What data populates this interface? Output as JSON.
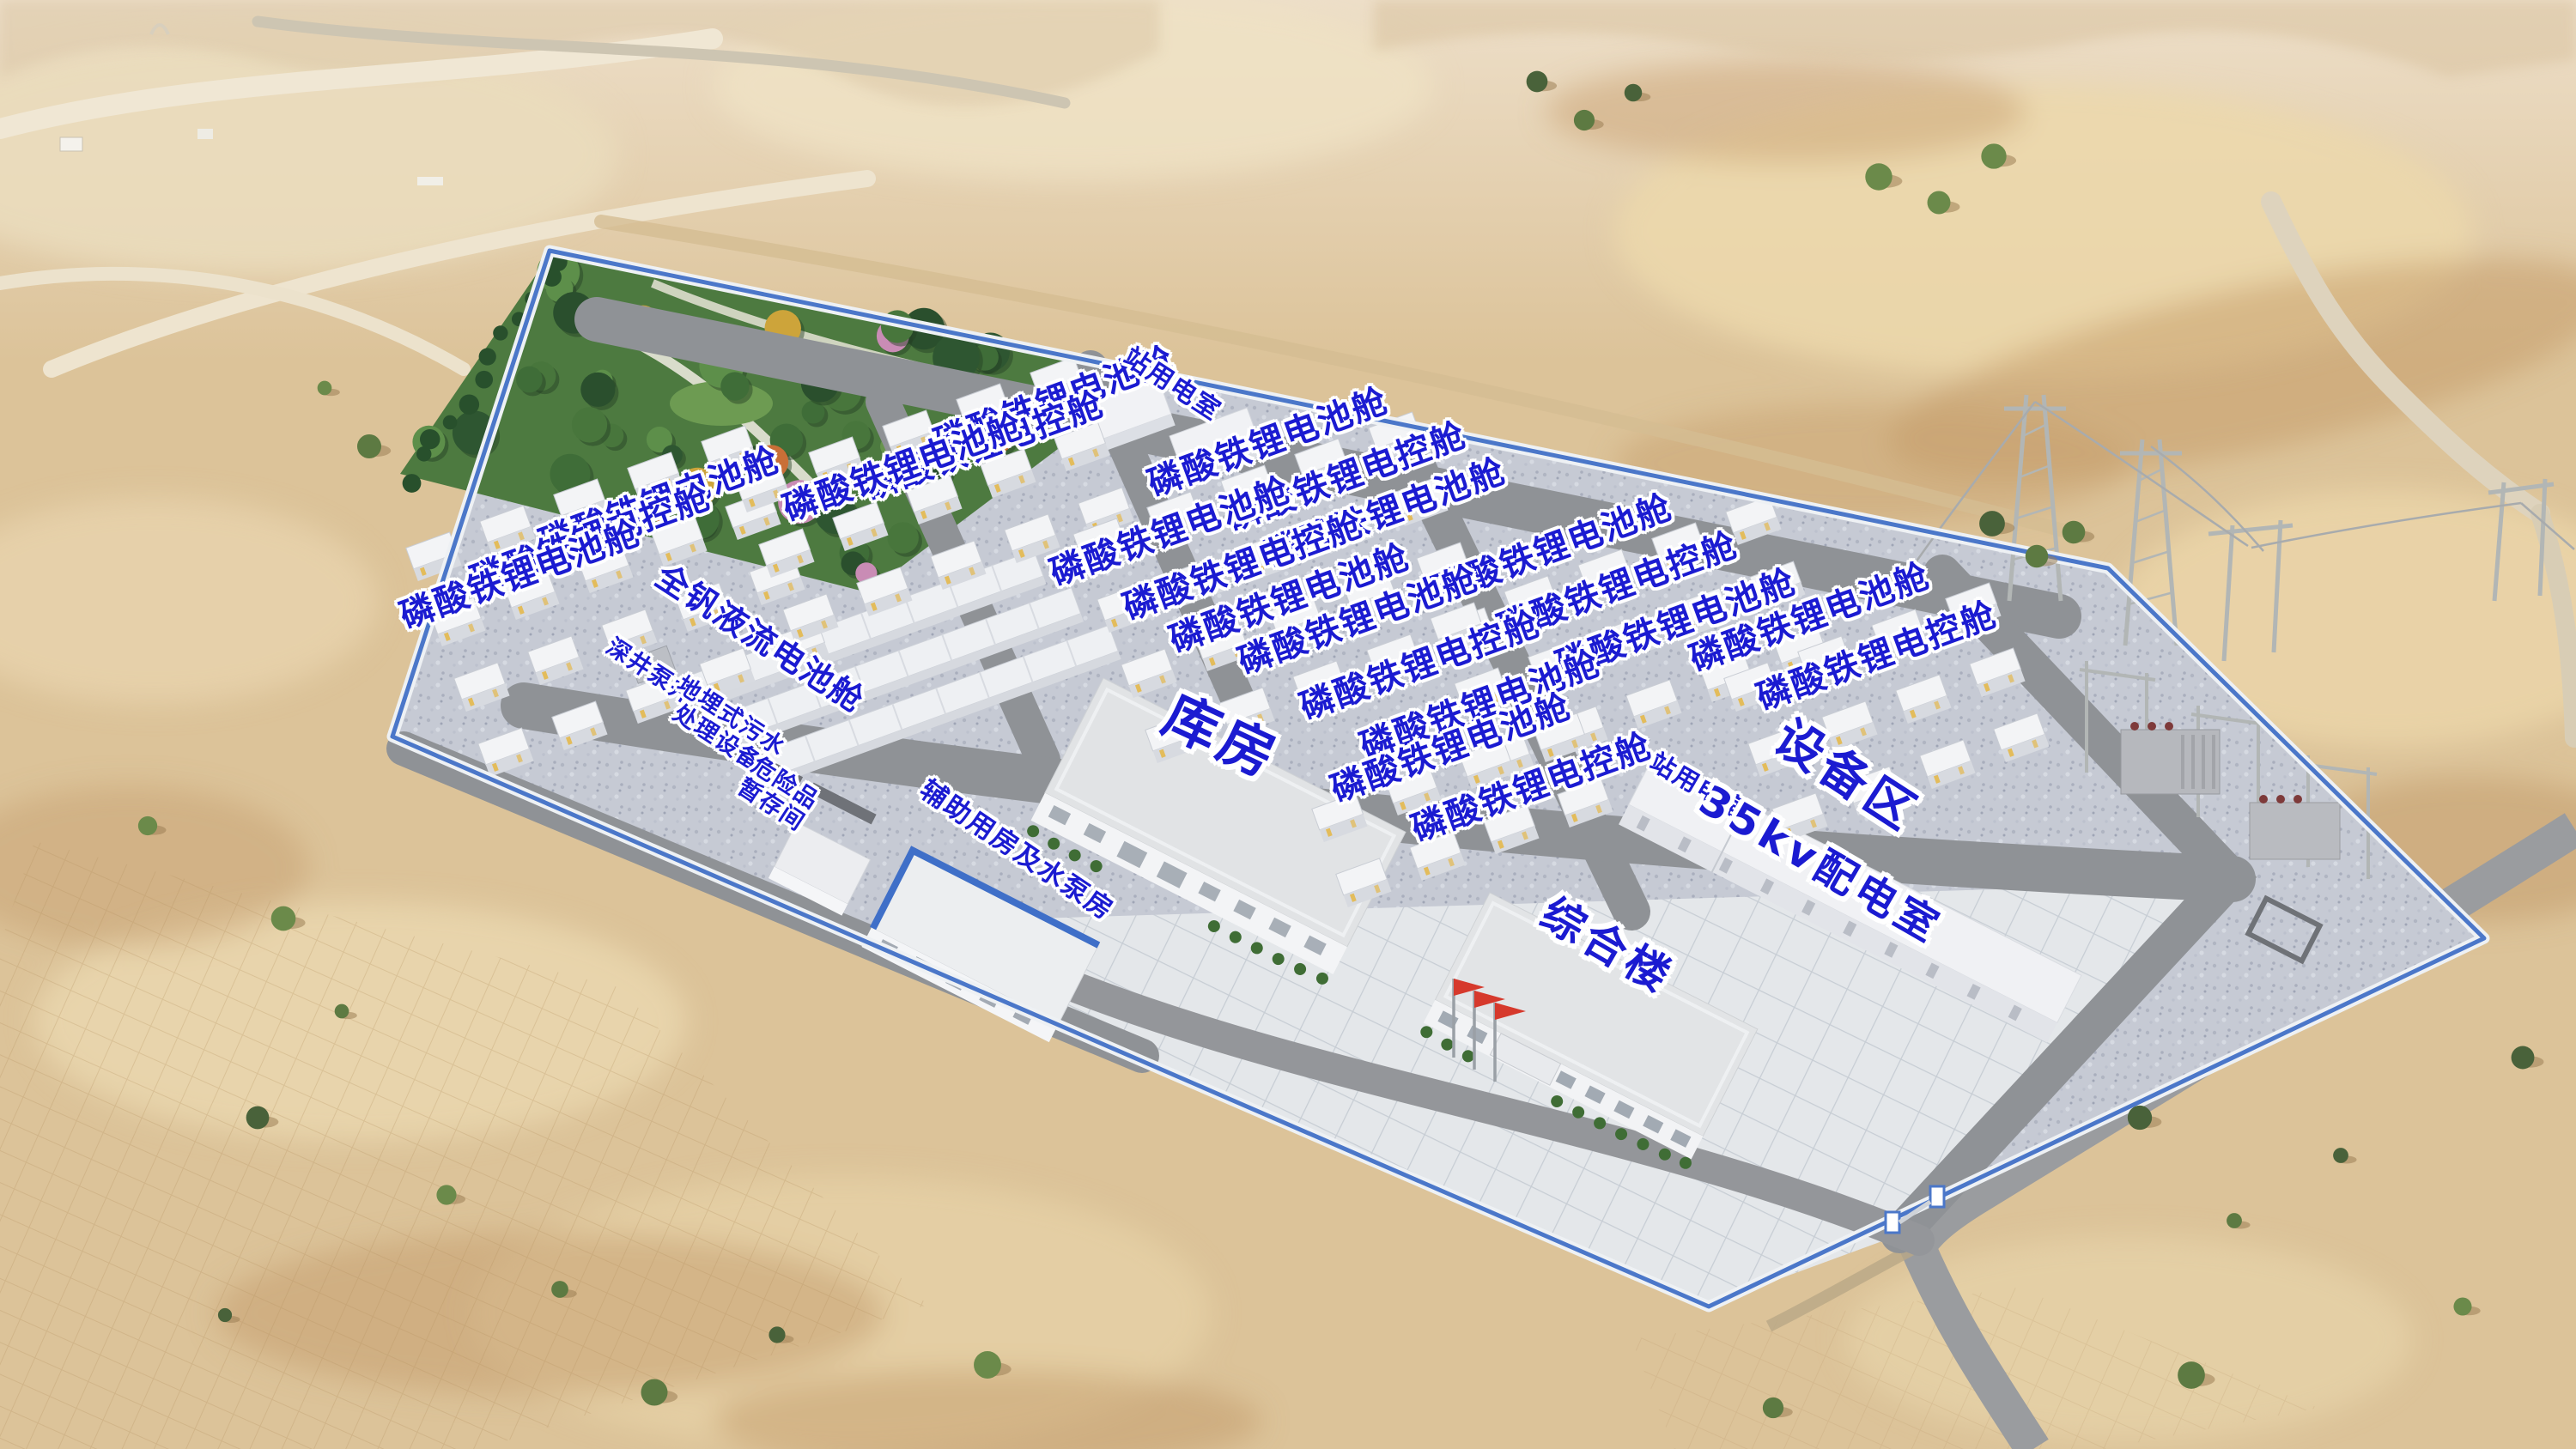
{
  "labels": {
    "battery_cabin": "磷酸铁锂电池舱",
    "control_cabin": "磷酸铁锂电控舱",
    "vanadium_flow_cabin": "全钒液流电池舱",
    "station_power_room": "站用电室",
    "deep_well_pump": "深井泵井",
    "sewage_treatment_line1": "地埋式污水",
    "sewage_treatment_line2": "处理设备",
    "hazardous_storage_line1": "危险品",
    "hazardous_storage_line2": "暂存间",
    "auxiliary_pump_house": "辅助用房及水泵房",
    "warehouse": "库房",
    "comprehensive_building": "综合楼",
    "distribution_room_35kv": "35kv配电室",
    "equipment_area": "设备区"
  },
  "colors": {
    "label_blue": "#1b1bd1",
    "fence_blue": "#4b77c9",
    "road_gray": "#8f9296",
    "sand": "#dcc399",
    "gravel_pad": "#c6cad4",
    "plaza": "#e4e7ea",
    "building_white": "#f2f3f5",
    "garden_green": "#4d7a40",
    "flag_red": "#d6392c"
  }
}
